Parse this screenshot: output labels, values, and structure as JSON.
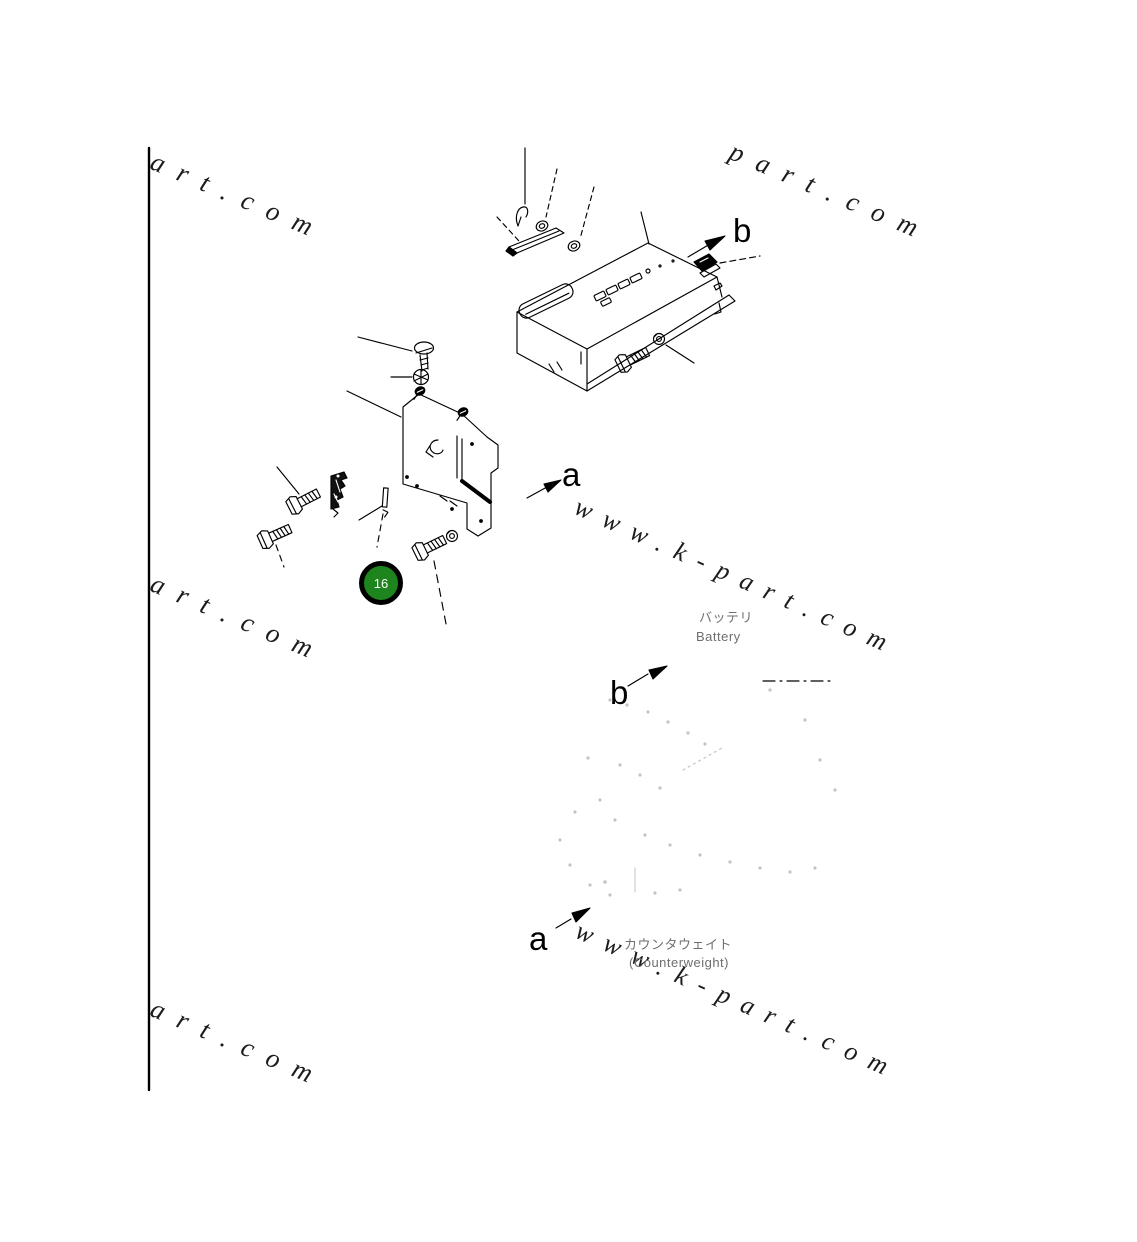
{
  "page": {
    "background": "#ffffff",
    "line_color": "#000000"
  },
  "watermarks": {
    "top_left": "art.com",
    "top_right": "part.com",
    "mid_left": "art.com",
    "mid_right": "www.k-part.com",
    "bottom_left": "art.com",
    "bottom_right": "www.k-part.com",
    "color": "#1c1c1c"
  },
  "diagram": {
    "view_labels": {
      "b_top": "b",
      "a_mid": "a",
      "b_mid": "b",
      "a_bottom": "a"
    },
    "part_marker": {
      "number": "16",
      "fill_color": "#1e851e",
      "ring_color": "#000000",
      "text_color": "#ffffff"
    },
    "annotations": {
      "battery_jp": "バッテリ",
      "battery_en": "Battery",
      "counterweight_jp": "カウンタウェイト",
      "counterweight_en": "(Counterweight)"
    }
  }
}
